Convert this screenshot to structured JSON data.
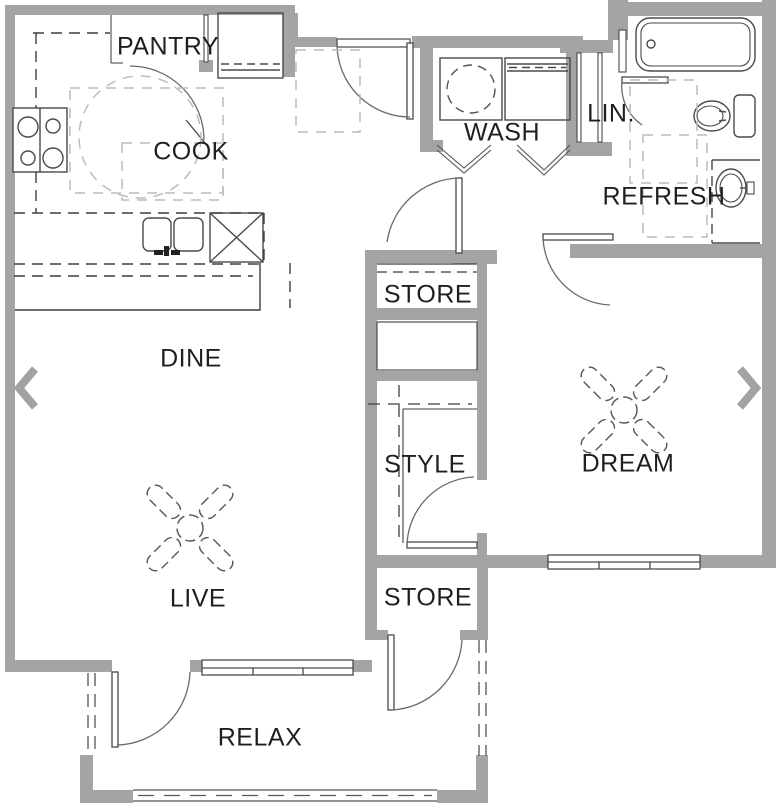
{
  "floorplan": {
    "rooms": {
      "pantry": "PANTRY",
      "cook": "COOK",
      "wash": "WASH",
      "linen": "LIN.",
      "refresh": "REFRESH",
      "dine": "DINE",
      "store_hall": "STORE",
      "style": "STYLE",
      "dream": "DREAM",
      "live": "LIVE",
      "store_patio": "STORE",
      "relax": "RELAX"
    },
    "fixtures": [
      "stove",
      "kitchen-sink",
      "dishwasher",
      "refrigerator",
      "pantry",
      "washer",
      "dryer",
      "bathtub",
      "toilet",
      "vanity-sink",
      "ceiling-fan-dream",
      "ceiling-fan-live",
      "bifold-doors",
      "patio-screen"
    ],
    "colors": {
      "wall": "#a4a4a4",
      "line": "#4a4a4a",
      "arc": "#6a6a6a",
      "clearance": "#bcbcbc",
      "background": "#ffffff",
      "text": "#1f1f1f"
    }
  },
  "nav": {
    "prev_icon": "chevron-left",
    "next_icon": "chevron-right"
  }
}
